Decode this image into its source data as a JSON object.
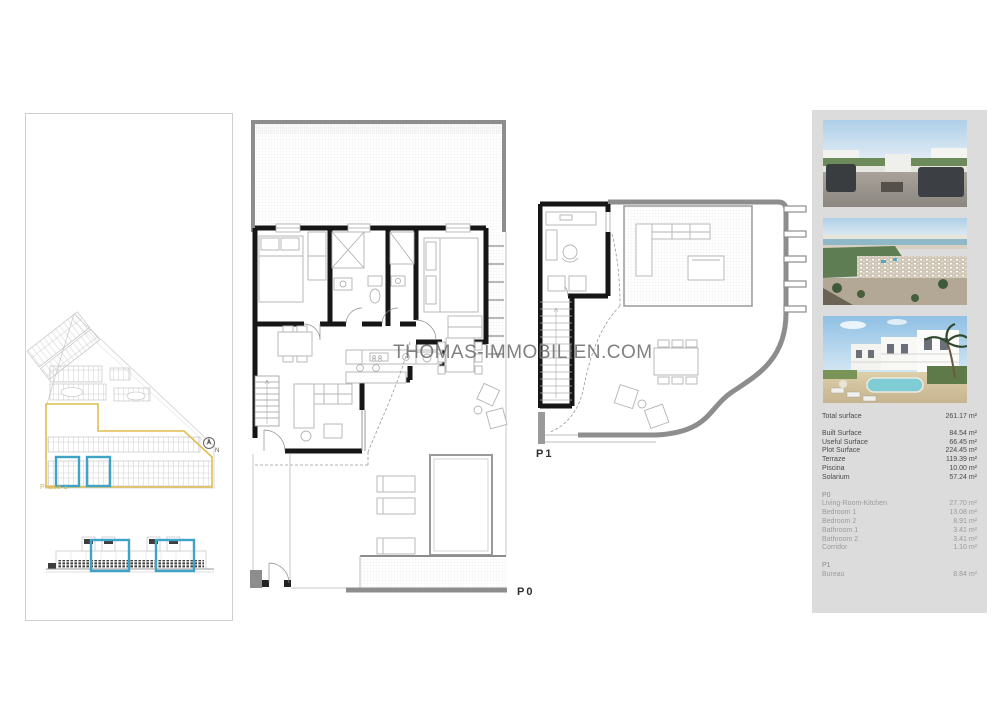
{
  "watermark": {
    "text": "THOMAS-IMMOBILIEN.COM"
  },
  "site_panel": {
    "phase_label": "Phase 1",
    "compass_label": "N",
    "phase_outline_color": "#e2bd4e",
    "unit_highlight_color": "#3fa3c8"
  },
  "floorplans": {
    "p0_label": "P0",
    "p1_label": "P1",
    "wall_color": "#161616",
    "boundary_color": "#8d8d8d"
  },
  "photos": [
    {
      "label": "roof-terrace-render"
    },
    {
      "label": "aerial-coast-render"
    },
    {
      "label": "residence-pool-render"
    }
  ],
  "surface_table": {
    "total": {
      "label": "Total surface",
      "value": "261.17 m²"
    },
    "main": [
      {
        "label": "Built Surface",
        "value": "84.54 m²"
      },
      {
        "label": "Useful Surface",
        "value": "66.45 m²"
      },
      {
        "label": "Plot Surface",
        "value": "224.45 m²"
      },
      {
        "label": "Terraze",
        "value": "119.39 m²"
      },
      {
        "label": "Piscina",
        "value": "10.00 m²"
      },
      {
        "label": "Solarium",
        "value": "57.24 m²"
      }
    ],
    "p0": {
      "header": "P0",
      "rows": [
        {
          "label": "Living-Room-Kitchen",
          "value": "27.70 m²"
        },
        {
          "label": "Bedroom 1",
          "value": "13.08 m²"
        },
        {
          "label": "Bedroom 2",
          "value": "8.91 m²"
        },
        {
          "label": "Bathroom 1",
          "value": "3.41 m²"
        },
        {
          "label": "Bathroom 2",
          "value": "3.41 m²"
        },
        {
          "label": "Corridor",
          "value": "1.10 m²"
        }
      ]
    },
    "p1": {
      "header": "P1",
      "rows": [
        {
          "label": "Bureau",
          "value": "8.84 m²"
        }
      ]
    }
  }
}
